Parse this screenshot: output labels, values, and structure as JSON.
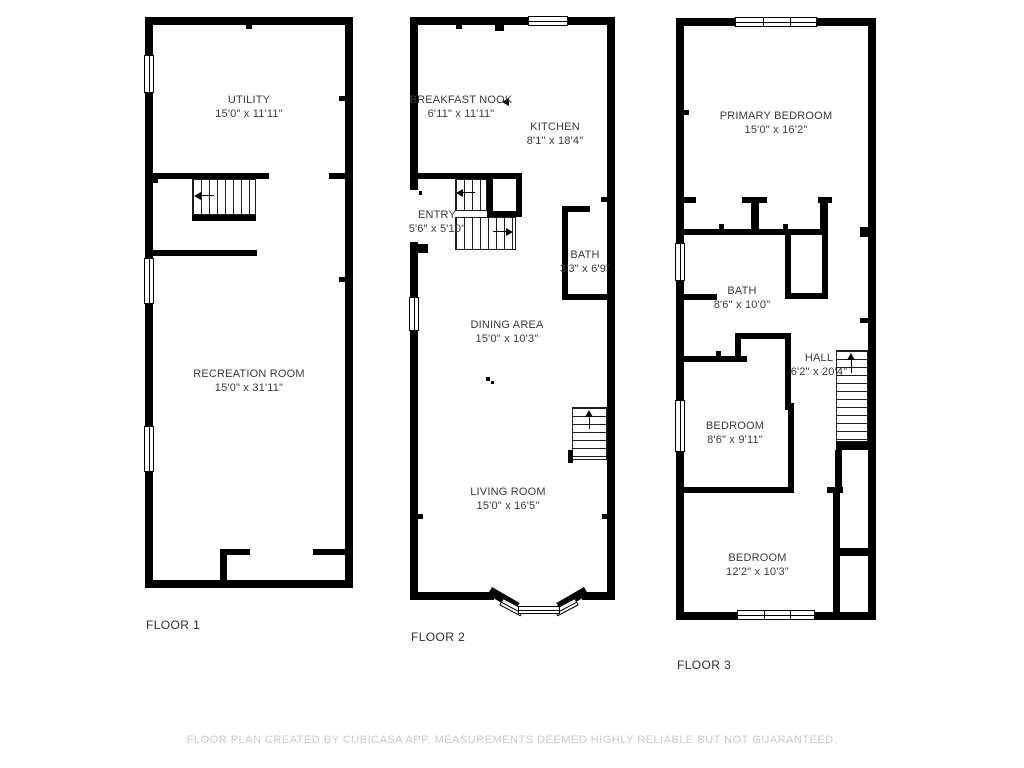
{
  "floors": [
    {
      "label": "FLOOR 1",
      "rooms": [
        {
          "name": "UTILITY",
          "dims": "15'0\" x 11'11\""
        },
        {
          "name": "RECREATION ROOM",
          "dims": "15'0\" x 31'11\""
        }
      ]
    },
    {
      "label": "FLOOR 2",
      "rooms": [
        {
          "name": "BREAKFAST NOOK",
          "dims": "6'11\" x 11'11\""
        },
        {
          "name": "KITCHEN",
          "dims": "8'1\" x 18'4\""
        },
        {
          "name": "ENTRY",
          "dims": "5'6\" x 5'10\""
        },
        {
          "name": "BATH",
          "dims": "3'3\" x 6'9\""
        },
        {
          "name": "DINING AREA",
          "dims": "15'0\" x 10'3\""
        },
        {
          "name": "LIVING ROOM",
          "dims": "15'0\" x 16'5\""
        }
      ]
    },
    {
      "label": "FLOOR 3",
      "rooms": [
        {
          "name": "PRIMARY BEDROOM",
          "dims": "15'0\" x 16'2\""
        },
        {
          "name": "BATH",
          "dims": "8'6\" x 10'0\""
        },
        {
          "name": "HALL",
          "dims": "6'2\" x 20'4\""
        },
        {
          "name": "BEDROOM",
          "dims": "8'6\" x 9'11\""
        },
        {
          "name": "BEDROOM",
          "dims": "12'2\" x 10'3\""
        }
      ]
    }
  ],
  "footer": {
    "disclaimer": "FLOOR PLAN CREATED BY CUBICASA APP. MEASUREMENTS DEEMED HIGHLY RELIABLE BUT NOT GUARANTEED."
  },
  "colors": {
    "wall": "#000000",
    "room_text": "#3b3b3b",
    "footer_text": "#c9c9c9"
  }
}
